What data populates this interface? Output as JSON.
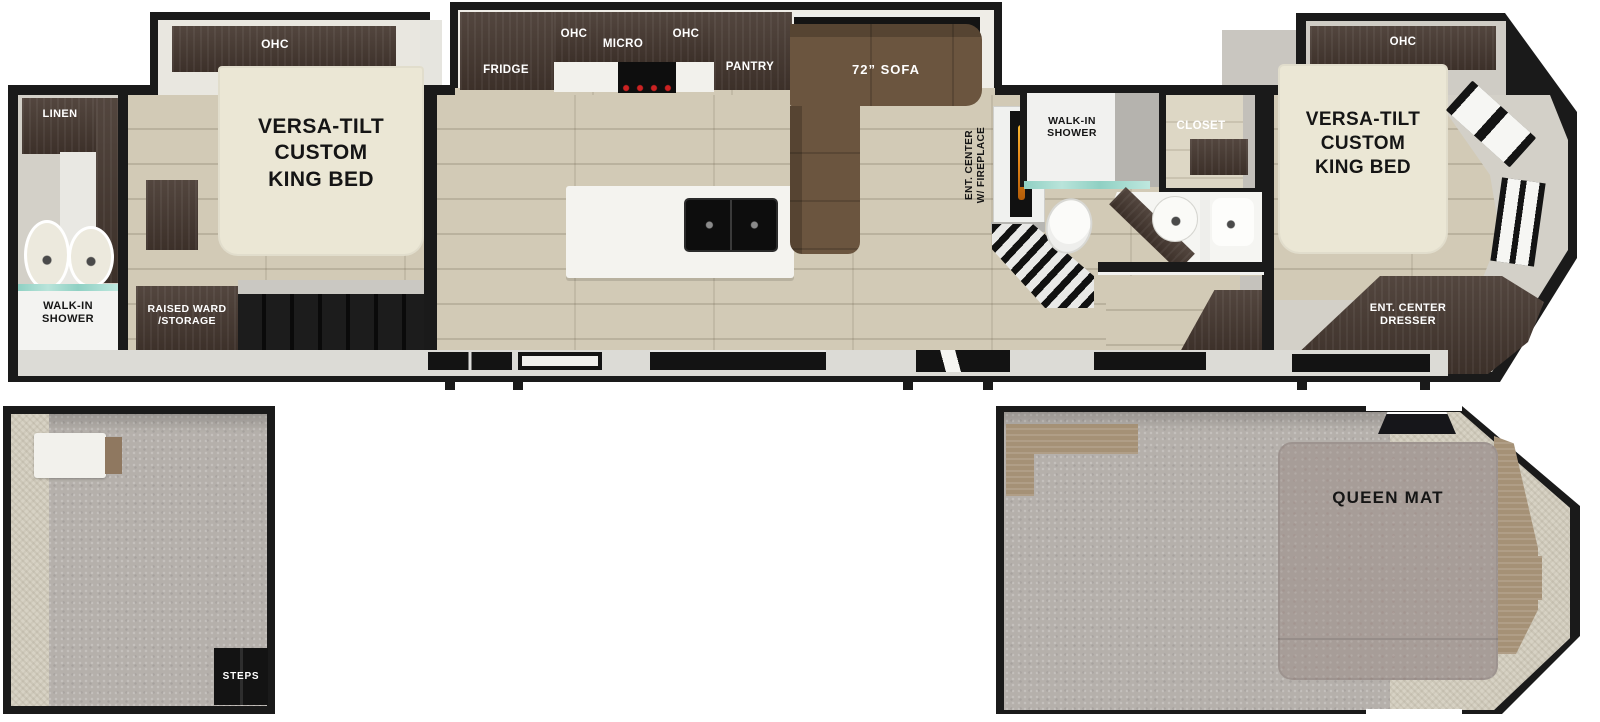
{
  "labels": {
    "linen": "LINEN",
    "shower_left": "WALK-IN\nSHOWER",
    "ohc_left": "OHC",
    "bed_left": "VERSA-TILT\nCUSTOM\nKING BED",
    "raised_ward": "RAISED WARD\n/STORAGE",
    "fridge": "FRIDGE",
    "ohc_kitchen_1": "OHC",
    "micro": "MICRO",
    "ohc_kitchen_2": "OHC",
    "pantry": "PANTRY",
    "sofa": "72” SOFA",
    "ent_center_fireplace": "ENT. CENTER\nW/ FIREPLACE",
    "shower_mid": "WALK-IN\nSHOWER",
    "closet": "CLOSET",
    "ohc_right": "OHC",
    "bed_right": "VERSA-TILT\nCUSTOM\nKING BED",
    "ent_center_dresser": "ENT. CENTER\nDRESSER",
    "steps": "STEPS",
    "queen_mat": "QUEEN MAT"
  },
  "colors": {
    "wall": "#1a1a1a",
    "interior_wall": "#d3d0c8",
    "wood_floor": "#d2cab6",
    "carpet": "#b5b0ab",
    "dark_cabinet": "#463830",
    "sofa_brown": "#6b553f",
    "bed_cream": "#ebe7d5",
    "queen_mat_gray": "#a79d98",
    "fireplace_flame": "#e8891a",
    "shower_glass": "#8fd0c3"
  }
}
